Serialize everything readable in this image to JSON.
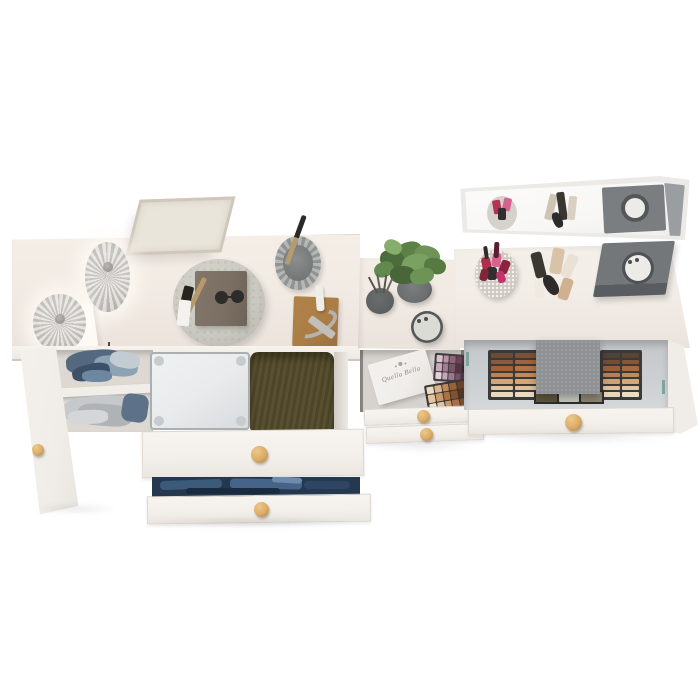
{
  "brand_box": {
    "label": "Quella Bella"
  },
  "colors": {
    "bg": "#ffffff",
    "desk_top": "#f2ebe4",
    "desk_top_edge": "#ddd4cb",
    "drawer_front": "#f3f0ec",
    "drawer_border": "#ddd6cf",
    "knob": "#dcab67",
    "knob_edge": "#a97c3e",
    "door": "#f0ece7",
    "interior": "#ddd8d2",
    "shelf": "#f1eee9",
    "suitcase": "#e9ebec",
    "suitcase_edge": "#a9afb2",
    "pillow": "#4e4526",
    "jeans": "#24384f",
    "tray": "#cbcac2",
    "notebook": "#7b6f63",
    "lamp": "#dcd9d4",
    "frame_border": "#cfc7ba",
    "frame_canvas": "#eae5db",
    "cup": "#9fa3a2",
    "cup_inner": "#747978",
    "board": "#aa7d46",
    "candle": "#efede8",
    "metal": "#b5b2ad",
    "table_top": "#f1eae3",
    "pot": "#6b6e6e",
    "diffuser": "#5e6161",
    "jar_dark": "#54585a",
    "jar_lid": "#dbdbd5",
    "box_face": "#f0eeea",
    "box_text": "#8f8a84",
    "mirror_frame": "#eceae6",
    "mirror_face": "#f8f7f6",
    "vanity_top": "#f3ede7",
    "dark_box": "#74777a",
    "dark_box_side": "#595d61",
    "drawer_interior": "#ccd0d2",
    "kit_frame": "#3a3a38",
    "fabric": "#8f9294",
    "sparkle": "#cfc9c2",
    "hinge": "#7fa49e"
  },
  "palettes": {
    "kit_left": [
      "#6e4a38",
      "#7d5038",
      "#8d5a3c",
      "#a0643c",
      "#a66038",
      "#b57448",
      "#bc8254",
      "#c28a58",
      "#cfa67c",
      "#d2a878",
      "#e2c49e",
      "#e0bf96",
      "#ead8bd",
      "#ecd9c2"
    ],
    "kit_right": [
      "#4f423a",
      "#5a4436",
      "#7a4c34",
      "#8a5638",
      "#9c5e38",
      "#a86a40",
      "#b97f52",
      "#c08a5c",
      "#caa178",
      "#d0a87e",
      "#dfc09a",
      "#e2c5a2",
      "#e9d6ba",
      "#eddcc4"
    ],
    "kit_pans": [
      "#5e563f",
      "#c7c8c2",
      "#8e8674"
    ],
    "mauve": [
      "#d9c2cc",
      "#b793a6",
      "#8f6478",
      "#6b4458",
      "#4a2e3e",
      "#c9a8b8",
      "#a07d92",
      "#7a5468",
      "#553244",
      "#3a2430",
      "#e3d2d8",
      "#c3aab8",
      "#9c7890",
      "#774f68",
      "#52334a"
    ],
    "nude": [
      "#ecd9c0",
      "#d9b68c",
      "#c08a58",
      "#9a6038",
      "#6b4227",
      "#e2c6a2",
      "#c89a68",
      "#aa7244",
      "#84502e",
      "#553420",
      "#f0e2cc",
      "#e0c4a0",
      "#c89868",
      "#a87048",
      "#7c4c2c"
    ]
  },
  "dots": {
    "plant_leaves": [
      {
        "x": 22,
        "y": 2,
        "w": 26,
        "h": 18,
        "c": "#5d8049",
        "rot": -15,
        "br": "45%"
      },
      {
        "x": 40,
        "y": 6,
        "w": 26,
        "h": 20,
        "c": "#6f9257",
        "rot": 18,
        "br": "45%"
      },
      {
        "x": 6,
        "y": 10,
        "w": 24,
        "h": 18,
        "c": "#4c6c3c",
        "rot": 8,
        "br": "45%"
      },
      {
        "x": 28,
        "y": 14,
        "w": 30,
        "h": 22,
        "c": "#7aa160",
        "rot": -6,
        "br": "45%"
      },
      {
        "x": 50,
        "y": 18,
        "w": 22,
        "h": 16,
        "c": "#557a42",
        "rot": 12,
        "br": "45%"
      },
      {
        "x": 0,
        "y": 22,
        "w": 20,
        "h": 15,
        "c": "#628a4e",
        "rot": -20,
        "br": "45%"
      },
      {
        "x": 16,
        "y": 26,
        "w": 26,
        "h": 18,
        "c": "#49663a",
        "rot": 5,
        "br": "45%"
      },
      {
        "x": 36,
        "y": 28,
        "w": 24,
        "h": 16,
        "c": "#6d9456",
        "rot": -12,
        "br": "45%"
      },
      {
        "x": 10,
        "y": 0,
        "w": 18,
        "h": 14,
        "c": "#86ad6c",
        "rot": 25,
        "br": "45%"
      }
    ],
    "diffuser_sticks": [
      {
        "x": 4,
        "y": -12,
        "w": 2,
        "h": 18,
        "c": "#55544e",
        "rot": -28,
        "br": "0"
      },
      {
        "x": 10,
        "y": -14,
        "w": 2,
        "h": 20,
        "c": "#62605a",
        "rot": -10,
        "br": "0"
      },
      {
        "x": 16,
        "y": -13,
        "w": 2,
        "h": 18,
        "c": "#55544e",
        "rot": 8,
        "br": "0"
      },
      {
        "x": 20,
        "y": -10,
        "w": 2,
        "h": 16,
        "c": "#6a6862",
        "rot": 24,
        "br": "0"
      }
    ],
    "shelf_clothes_blue": [
      {
        "x": 18,
        "y": 0,
        "w": 58,
        "h": 24,
        "c": "#54697f",
        "rot": -5,
        "br": "40%"
      },
      {
        "x": 46,
        "y": 6,
        "w": 44,
        "h": 20,
        "c": "#8da2b3",
        "rot": 6,
        "br": "40%"
      },
      {
        "x": 24,
        "y": 14,
        "w": 38,
        "h": 16,
        "c": "#3e5068",
        "rot": -12,
        "br": "40%"
      },
      {
        "x": 62,
        "y": 2,
        "w": 30,
        "h": 16,
        "c": "#c3ccd3",
        "rot": 10,
        "br": "40%"
      },
      {
        "x": 34,
        "y": 20,
        "w": 30,
        "h": 12,
        "c": "#6e87a0",
        "rot": 0,
        "br": "40%"
      }
    ],
    "shelf_clothes_gray": [
      {
        "x": 16,
        "y": 46,
        "w": 64,
        "h": 26,
        "c": "#c6c9cb",
        "rot": -4,
        "br": "35%"
      },
      {
        "x": 30,
        "y": 54,
        "w": 54,
        "h": 22,
        "c": "#afb3b6",
        "rot": 4,
        "br": "35%"
      },
      {
        "x": 74,
        "y": 44,
        "w": 26,
        "h": 28,
        "c": "#5d7189",
        "rot": 8,
        "br": "30%"
      },
      {
        "x": 20,
        "y": 60,
        "w": 40,
        "h": 14,
        "c": "#d4d6d8",
        "rot": -2,
        "br": "35%"
      }
    ],
    "jeans_folds": [
      {
        "x": 8,
        "y": 3,
        "w": 62,
        "h": 9,
        "c": "#3c5a7a",
        "rot": -2,
        "br": "4px"
      },
      {
        "x": 78,
        "y": 2,
        "w": 72,
        "h": 10,
        "c": "#46648a",
        "rot": 1,
        "br": "4px"
      },
      {
        "x": 152,
        "y": 4,
        "w": 46,
        "h": 8,
        "c": "#2e4664",
        "rot": 0,
        "br": "4px"
      },
      {
        "x": 34,
        "y": 11,
        "w": 94,
        "h": 6,
        "c": "#1b2b3f",
        "rot": 0,
        "br": "3px"
      },
      {
        "x": 120,
        "y": 0,
        "w": 30,
        "h": 6,
        "c": "#6d8cab",
        "rot": 3,
        "br": "3px"
      }
    ],
    "tray_items": [
      {
        "x": 14,
        "y": 6,
        "w": 5,
        "h": 38,
        "c": "#b89a6a",
        "rot": 26,
        "br": "2px"
      },
      {
        "x": 2,
        "y": 16,
        "w": 10,
        "h": 20,
        "c": "#26231f",
        "rot": 14,
        "br": "2px"
      },
      {
        "x": -2,
        "y": 30,
        "w": 12,
        "h": 26,
        "c": "#f4f2ee",
        "rot": 6,
        "br": "2px"
      }
    ],
    "lipsticks": [
      {
        "x": 7,
        "y": 7,
        "w": 9,
        "h": 15,
        "c": "#b02e4a",
        "rot": -12,
        "br": "3px"
      },
      {
        "x": 17,
        "y": 3,
        "w": 9,
        "h": 14,
        "c": "#d4648e",
        "rot": 8,
        "br": "3px"
      },
      {
        "x": 25,
        "y": 10,
        "w": 9,
        "h": 14,
        "c": "#8e2140",
        "rot": 22,
        "br": "3px"
      },
      {
        "x": 12,
        "y": 17,
        "w": 10,
        "h": 13,
        "c": "#332e30",
        "rot": 0,
        "br": "3px"
      },
      {
        "x": 22,
        "y": 21,
        "w": 8,
        "h": 12,
        "c": "#c2346a",
        "rot": -18,
        "br": "3px"
      },
      {
        "x": 5,
        "y": 19,
        "w": 8,
        "h": 12,
        "c": "#7c2838",
        "rot": 14,
        "br": "3px"
      },
      {
        "x": 19,
        "y": -8,
        "w": 5,
        "h": 16,
        "c": "#581e31",
        "rot": 3,
        "br": "2px"
      },
      {
        "x": 9,
        "y": -4,
        "w": 4,
        "h": 13,
        "c": "#2e2b2c",
        "rot": -8,
        "br": "2px"
      }
    ],
    "makeup_tubes": [
      {
        "x": 3,
        "y": 4,
        "w": 11,
        "h": 26,
        "c": "#3b3731",
        "rot": -14,
        "br": "3px"
      },
      {
        "x": 21,
        "y": 0,
        "w": 12,
        "h": 26,
        "c": "#d9c3a8",
        "rot": 10,
        "br": "3px"
      },
      {
        "x": 34,
        "y": 6,
        "w": 11,
        "h": 24,
        "c": "#e9e1d4",
        "rot": 24,
        "br": "3px"
      },
      {
        "x": 15,
        "y": 26,
        "w": 12,
        "h": 22,
        "c": "#2f2b2a",
        "rot": -32,
        "br": "45%"
      },
      {
        "x": 30,
        "y": 30,
        "w": 11,
        "h": 22,
        "c": "#cfb091",
        "rot": 18,
        "br": "3px"
      },
      {
        "x": 5,
        "y": 32,
        "w": 9,
        "h": 18,
        "c": "#efe9e0",
        "rot": -6,
        "br": "3px"
      }
    ],
    "mirror_reflection": [
      {
        "x": 204,
        "y": 0,
        "w": 20,
        "h": 54,
        "c": "#9b9ea0",
        "rot": -6,
        "br": "0"
      },
      {
        "x": 24,
        "y": 14,
        "w": 30,
        "h": 34,
        "c": "#d6d1ca",
        "rot": 0,
        "br": "50%"
      },
      {
        "x": 30,
        "y": 18,
        "w": 8,
        "h": 14,
        "c": "#b43355",
        "rot": -10,
        "br": "2px"
      },
      {
        "x": 40,
        "y": 16,
        "w": 8,
        "h": 13,
        "c": "#d4648e",
        "rot": 12,
        "br": "2px"
      },
      {
        "x": 35,
        "y": 26,
        "w": 8,
        "h": 12,
        "c": "#332e30",
        "rot": 0,
        "br": "2px"
      },
      {
        "x": 84,
        "y": 12,
        "w": 8,
        "h": 26,
        "c": "#cfc4b4",
        "rot": 14,
        "br": "2px"
      },
      {
        "x": 95,
        "y": 10,
        "w": 8,
        "h": 28,
        "c": "#3a3732",
        "rot": -8,
        "br": "2px"
      },
      {
        "x": 105,
        "y": 14,
        "w": 8,
        "h": 24,
        "c": "#d9cfc2",
        "rot": 6,
        "br": "2px"
      },
      {
        "x": 90,
        "y": 30,
        "w": 9,
        "h": 16,
        "c": "#2f2b2a",
        "rot": -24,
        "br": "40%"
      },
      {
        "x": 140,
        "y": 4,
        "w": 62,
        "h": 46,
        "c": "#7b7e80",
        "rot": -3,
        "br": "2px"
      },
      {
        "x": 158,
        "y": 12,
        "w": 28,
        "h": 28,
        "c": "#54575a",
        "rot": 0,
        "br": "50%"
      },
      {
        "x": 162,
        "y": 16,
        "w": 20,
        "h": 20,
        "c": "#edebe7",
        "rot": 0,
        "br": "50%"
      }
    ],
    "jar_lid_specks": [
      {
        "x": 6,
        "y": 8,
        "w": 4,
        "h": 4,
        "c": "#4c4c4a",
        "rot": 0,
        "br": "50%"
      },
      {
        "x": 13,
        "y": 6,
        "w": 4,
        "h": 4,
        "c": "#4c4c4a",
        "rot": 0,
        "br": "50%"
      }
    ]
  }
}
